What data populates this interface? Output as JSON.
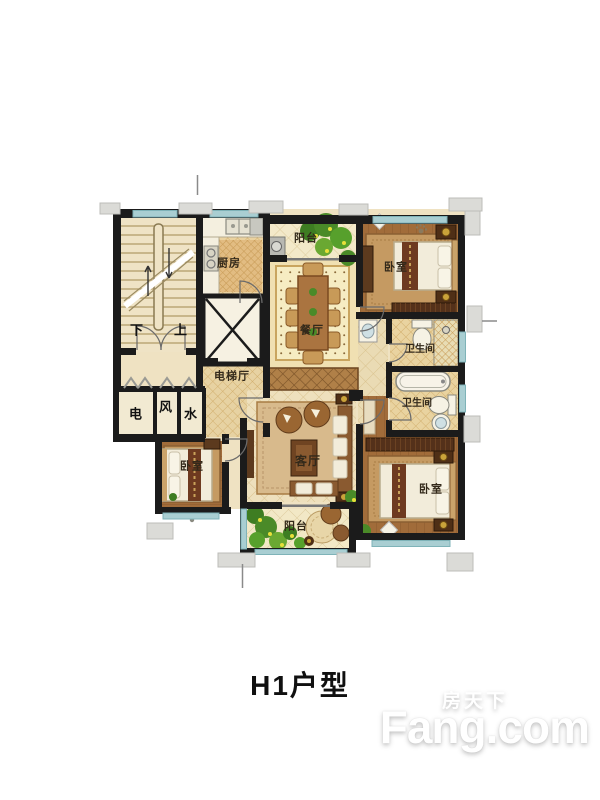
{
  "title": "H1户型",
  "labels": {
    "balcony_top": "阳台",
    "kitchen": "厨房",
    "bedroom_top_right": "卧室",
    "dining": "餐厅",
    "stairs_down": "下",
    "stairs_up": "上",
    "elevator_hall": "电梯厅",
    "bath_upper": "卫生间",
    "bath_lower": "卫生间",
    "shaft_electric": "电",
    "shaft_air": "风",
    "shaft_water": "水",
    "bedroom_left": "卧室",
    "living": "客厅",
    "balcony_bottom": "阳台",
    "bedroom_bottom_right": "卧室"
  },
  "watermark": {
    "brand_cn": "房天下",
    "brand_en": "Fang.com"
  },
  "colors": {
    "wall": "#1b1b1b",
    "window_glass": "#a9ced2",
    "floor_cream": "#efe2c2",
    "floor_wood": "#a16c3a",
    "rug": "#c59a62",
    "dining_rug": "#f6ecc2",
    "furniture_dark": "#54311a",
    "sofa_brown": "#8a5a30",
    "plant_green": "#4a8a28",
    "section_tab": "#dbdbd7",
    "title_text": "#101010",
    "watermark_text": "#ffffff"
  }
}
